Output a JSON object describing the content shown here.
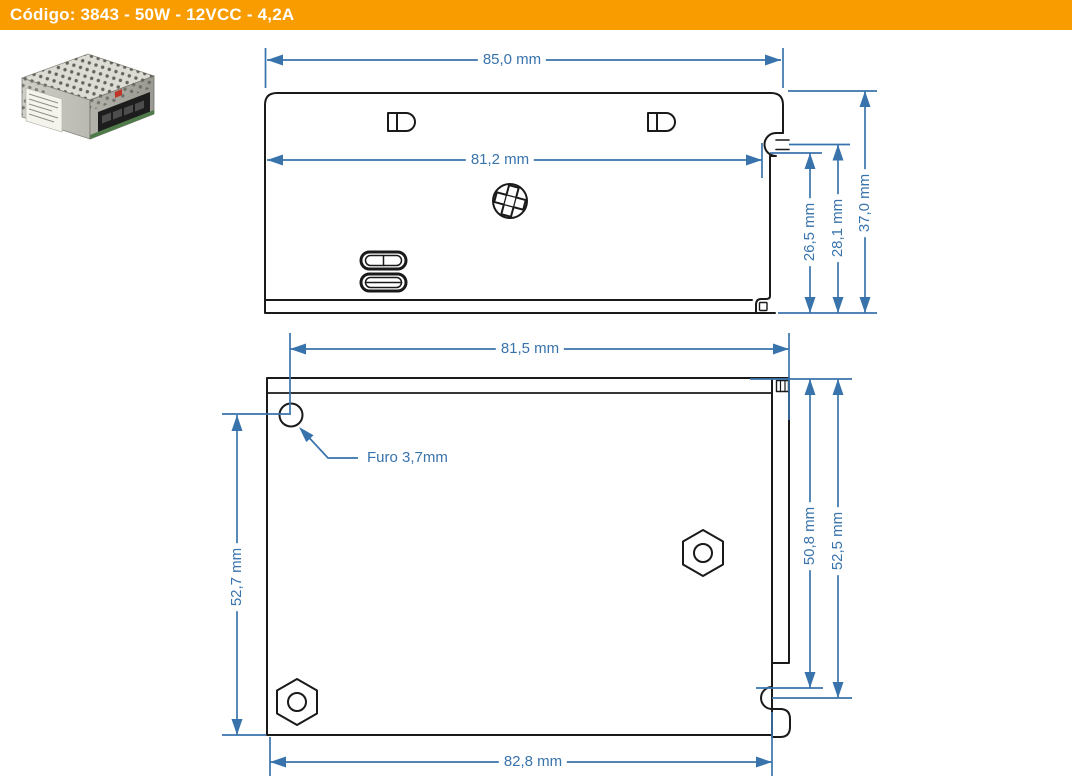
{
  "header": {
    "title": "Código: 3843 - 50W - 12VCC - 4,2A",
    "bg_color": "#F99C00",
    "text_color": "#FFFFFF"
  },
  "product_photo": {
    "name": "metal-enclosure-power-supply-photo"
  },
  "drawing": {
    "line_color": "#1A1A1A",
    "dimension_color": "#3973AC",
    "views": {
      "side_view": {
        "dim_width_overall": "85,0 mm",
        "dim_width_keyslot": "81,2 mm",
        "dim_height_keyslot": "26,5 mm",
        "dim_height_step": "28,1 mm",
        "dim_height_overall": "37,0 mm"
      },
      "top_view": {
        "dim_width_top": "81,5 mm",
        "hole_callout": "Furo 3,7mm",
        "dim_height_left": "52,7 mm",
        "dim_height_inner": "50,8 mm",
        "dim_height_right": "52,5 mm",
        "dim_width_bottom": "82,8 mm"
      }
    }
  }
}
